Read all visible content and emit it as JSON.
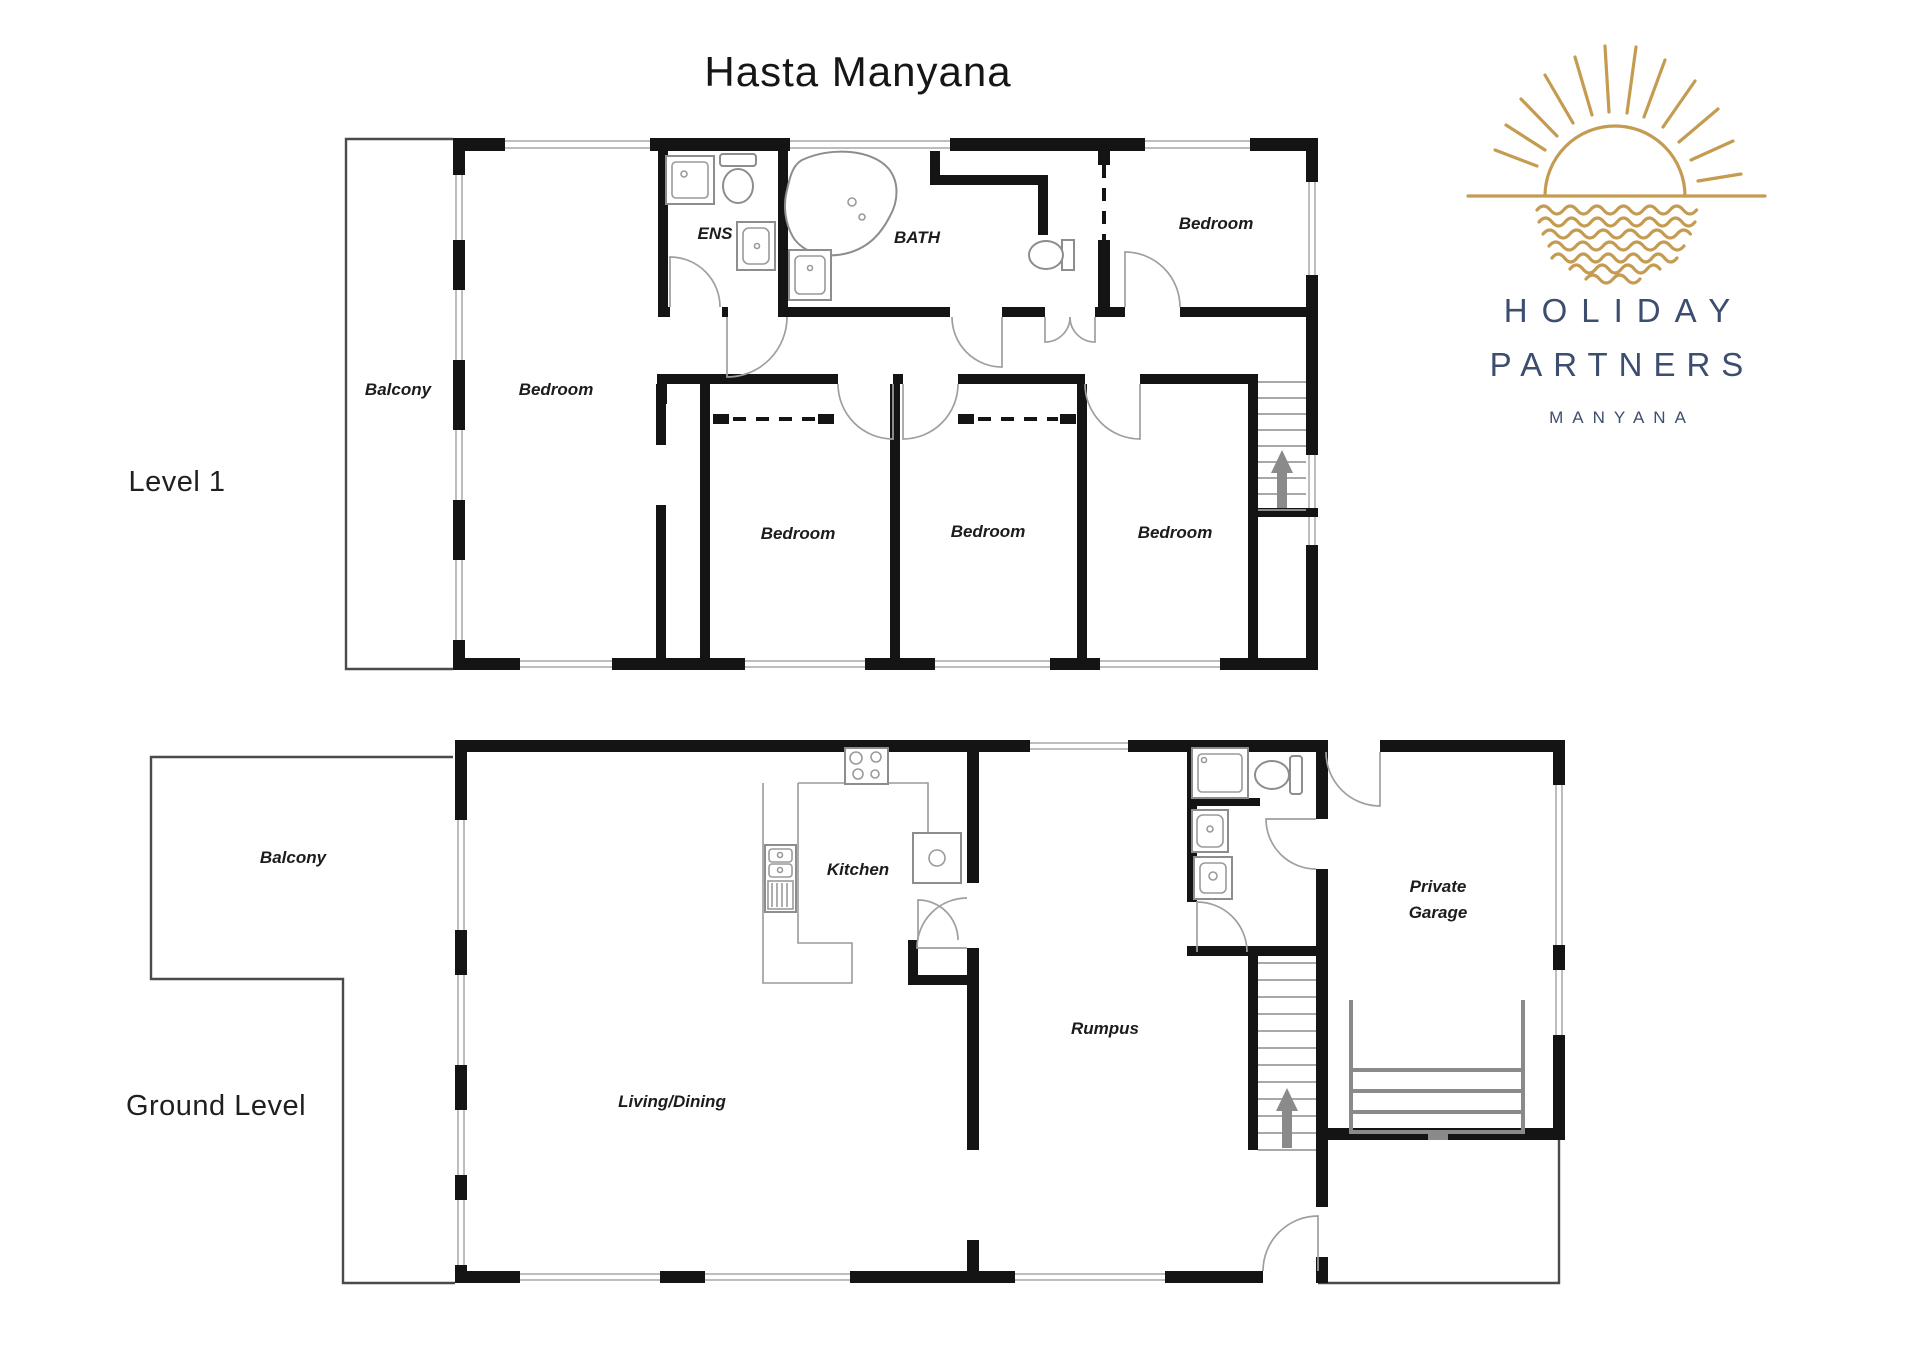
{
  "title": "Hasta Manyana",
  "level1": {
    "label": "Level 1",
    "balcony": "Balcony",
    "master_bedroom": "Bedroom",
    "ens": "ENS",
    "bath": "BATH",
    "bedroom_top_right": "Bedroom",
    "bedroom_a": "Bedroom",
    "bedroom_b": "Bedroom",
    "bedroom_c": "Bedroom"
  },
  "ground": {
    "label": "Ground Level",
    "balcony": "Balcony",
    "kitchen": "Kitchen",
    "living_dining": "Living/Dining",
    "rumpus": "Rumpus",
    "garage_line1": "Private",
    "garage_line2": "Garage"
  },
  "logo": {
    "line1": "HOLIDAY",
    "line2": "PARTNERS",
    "line3": "MANYANA",
    "sun_color": "#C49B51",
    "text_color": "#3D4D6F"
  }
}
